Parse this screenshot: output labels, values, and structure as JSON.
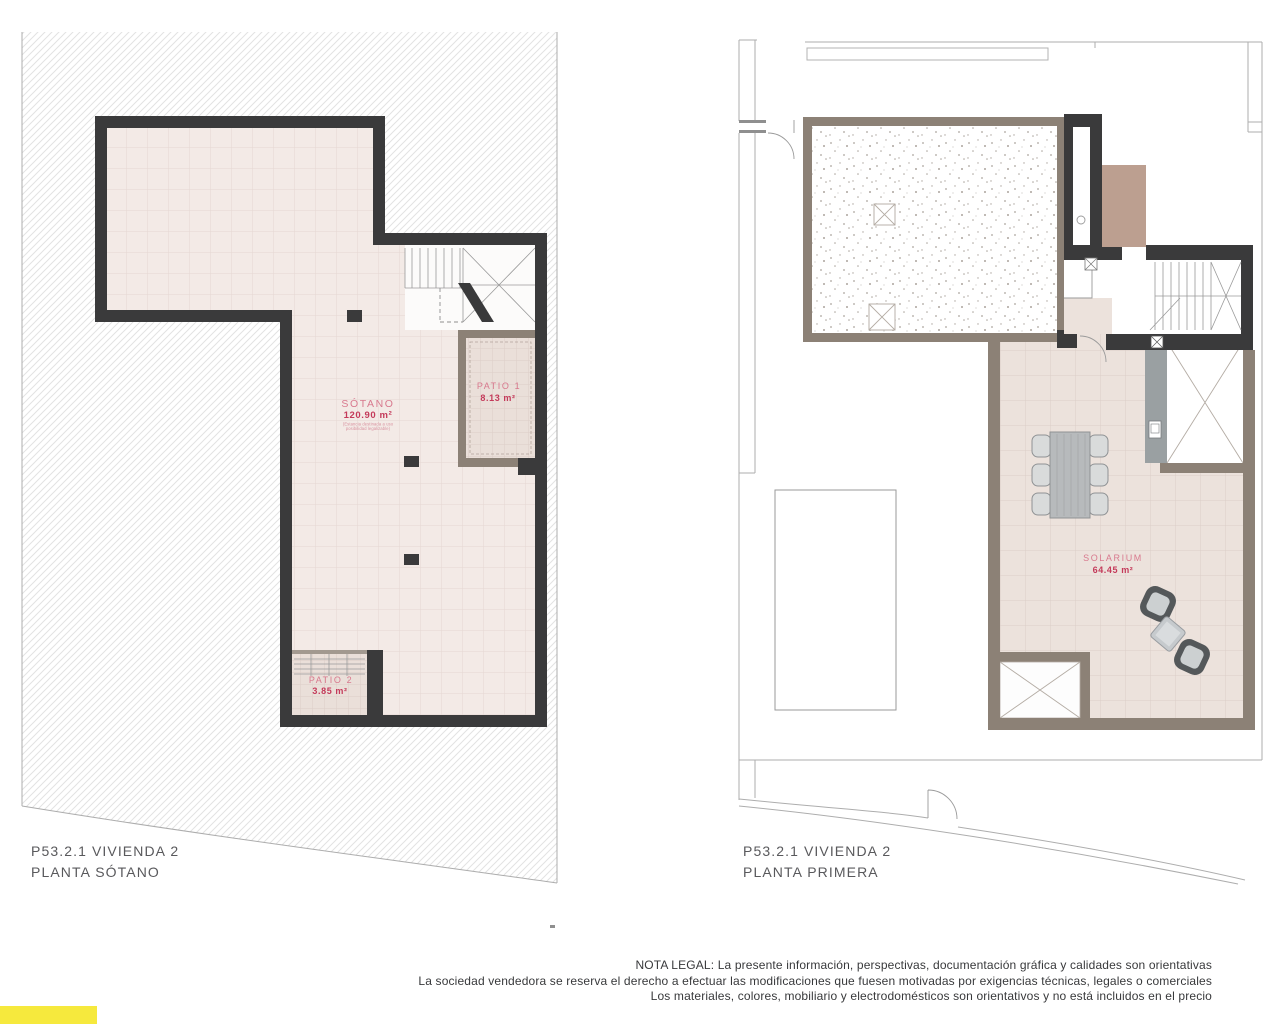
{
  "plans": {
    "basement": {
      "title_line1": "P53.2.1 VIVIENDA 2",
      "title_line2": "PLANTA SÓTANO",
      "rooms": {
        "sotano": {
          "name": "SÓTANO",
          "area": "120.90 m²",
          "note_line1": "(Estancia destinada a uso",
          "note_line2": "posibilidad legalizable)"
        },
        "patio1": {
          "name": "PATIO 1",
          "area": "8.13 m²"
        },
        "patio2": {
          "name": "PATIO 2",
          "area": "3.85 m²"
        }
      }
    },
    "first_floor": {
      "title_line1": "P53.2.1 VIVIENDA 2",
      "title_line2": "PLANTA PRIMERA",
      "rooms": {
        "solarium": {
          "name": "SOLARIUM",
          "area": "64.45 m²"
        }
      }
    }
  },
  "footer": {
    "legal_note": {
      "line1": "NOTA LEGAL: La presente información, perspectivas, documentación gráfica y calidades son orientativas",
      "line2": "La sociedad vendedora se reserva el derecho a efectuar las modificaciones que fuesen motivadas por exigencias técnicas, legales o comerciales",
      "line3": "Los materiales, colores, mobiliario y electrodomésticos son orientativos y no está incluidos en el precio"
    }
  },
  "colors": {
    "wall_dark": "#3a3a3b",
    "wall_gray": "#8c8176",
    "floor_pink": "#f3eae6",
    "floor_patio": "#eadfd9",
    "floor_solarium": "#ece2dc",
    "room_label": "#d8798e",
    "room_area": "#c43a5a",
    "plan_label": "#59595c",
    "legal_text": "#38393b",
    "tan_block": "#bc9f90",
    "accent_bar": "#f6e93d",
    "counter": "#9aa0a2"
  }
}
